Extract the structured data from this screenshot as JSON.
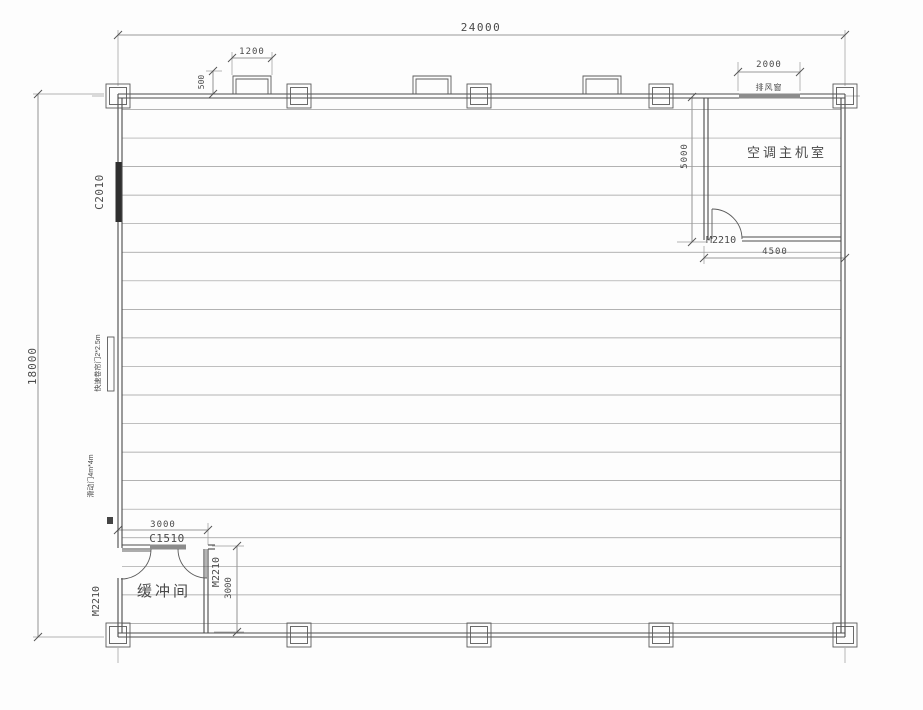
{
  "plan": {
    "rooms": {
      "ac_room": "空调主机室",
      "buffer_room": "缓冲间"
    },
    "windows": {
      "left_window": "C2010",
      "buffer_window": "C1510",
      "exhaust_window_label": "排风窗"
    },
    "doors": {
      "left_door": "M2210",
      "buffer_door": "M2210",
      "ac_door": "M2210",
      "rollup_door_label": "快速卷帘门2*2.5m",
      "sliding_door_label": "滑动门4m*4m"
    },
    "dimensions": {
      "overall_width": "24000",
      "overall_depth": "18000",
      "roof_vent_width": "1200",
      "roof_vent_height": "500",
      "exhaust_window_width": "2000",
      "ac_room_depth": "5000",
      "ac_room_width": "4500",
      "buffer_room_width": "3000",
      "buffer_room_depth": "3000"
    },
    "roof_lines": {
      "count": 19,
      "x1": 122,
      "x2": 841,
      "y_start": 109.5,
      "y_step": 28.55,
      "color": "#9a9a9a"
    },
    "colors": {
      "wall": "#4a4a4a",
      "thin_line": "#9a9a9a",
      "dimension": "#777777",
      "text": "#4a4a4a",
      "window_dark": "#2f2f2f",
      "window_gray": "#8c8c8c",
      "background": "#fdfdfd"
    }
  }
}
